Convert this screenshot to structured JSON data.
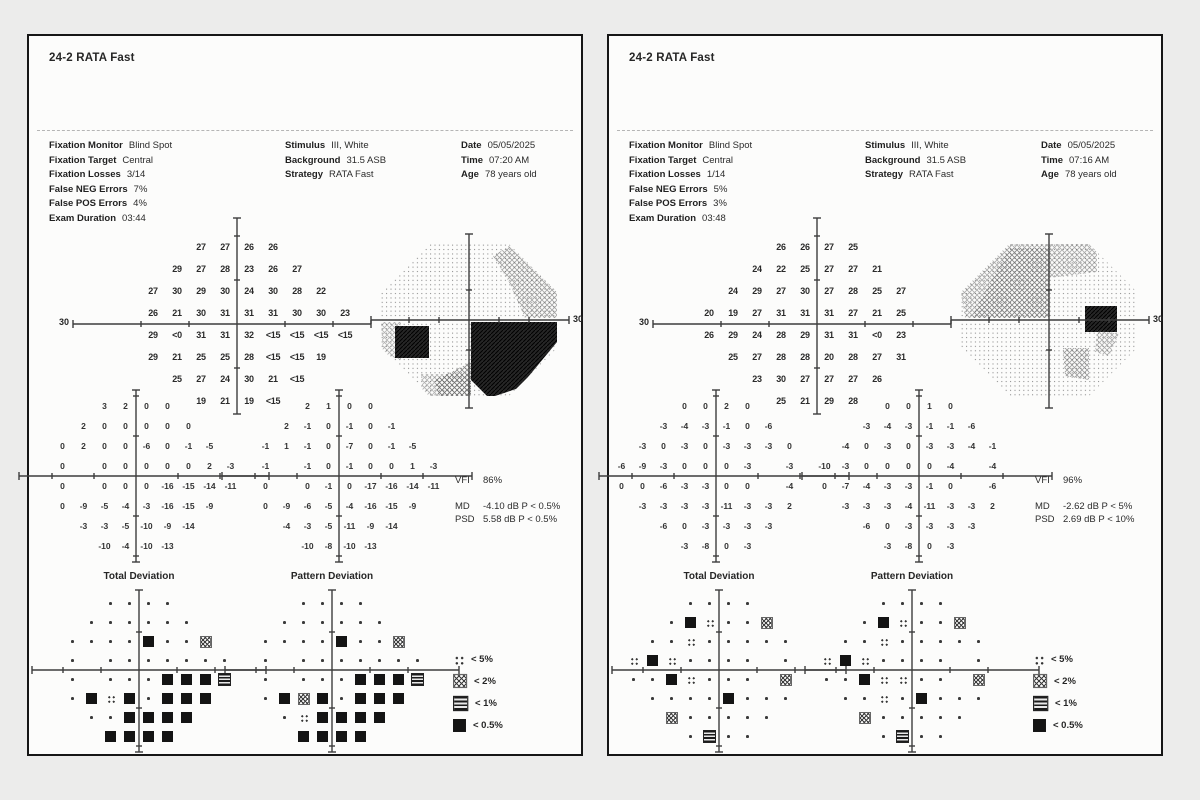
{
  "legend": [
    {
      "sym": "p5",
      "label": "< 5%"
    },
    {
      "sym": "p2",
      "label": "< 2%"
    },
    {
      "sym": "p1",
      "label": "< 1%"
    },
    {
      "sym": "p05",
      "label": "< 0.5%"
    }
  ],
  "pages": [
    {
      "title": "24-2 RATA Fast",
      "info": {
        "col1": [
          [
            "Fixation Monitor",
            "Blind Spot"
          ],
          [
            "Fixation Target",
            "Central"
          ],
          [
            "Fixation Losses",
            "3/14"
          ],
          [
            "False NEG Errors",
            "7%"
          ],
          [
            "False POS Errors",
            "4%"
          ],
          [
            "Exam Duration",
            "03:44"
          ]
        ],
        "col2": [
          [
            "Stimulus",
            "III, White"
          ],
          [
            "Background",
            "31.5 ASB"
          ],
          [
            "Strategy",
            "RATA Fast"
          ]
        ],
        "col3": [
          [
            "Date",
            "05/05/2025"
          ],
          [
            "Time",
            "07:20 AM"
          ],
          [
            "Age",
            "78 years old"
          ]
        ]
      },
      "axis_left_label": "30",
      "axis_right_label": "30",
      "sensitivity": [
        [
          null,
          null,
          null,
          "27",
          "27",
          "26",
          "26",
          null,
          null,
          null
        ],
        [
          null,
          null,
          "29",
          "27",
          "28",
          "23",
          "26",
          "27",
          null,
          null
        ],
        [
          null,
          "27",
          "30",
          "29",
          "30",
          "24",
          "30",
          "28",
          "22",
          null
        ],
        [
          null,
          "26",
          "21",
          "30",
          "31",
          "31",
          "31",
          "30",
          "30",
          "23"
        ],
        [
          null,
          "29",
          "<0",
          "31",
          "31",
          "32",
          "<15",
          "<15",
          "<15",
          "<15"
        ],
        [
          null,
          "29",
          "21",
          "25",
          "25",
          "28",
          "<15",
          "<15",
          "19",
          null
        ],
        [
          null,
          null,
          "25",
          "27",
          "24",
          "30",
          "21",
          "<15",
          null,
          null
        ],
        [
          null,
          null,
          null,
          "19",
          "21",
          "19",
          "<15",
          null,
          null,
          null
        ]
      ],
      "total_deviation": [
        [
          null,
          null,
          null,
          "3",
          "2",
          "0",
          "0",
          null,
          null,
          null
        ],
        [
          null,
          null,
          "2",
          "0",
          "0",
          "0",
          "0",
          "0",
          null,
          null
        ],
        [
          null,
          "0",
          "2",
          "0",
          "0",
          "-6",
          "0",
          "-1",
          "-5",
          null
        ],
        [
          null,
          "0",
          null,
          "0",
          "0",
          "0",
          "0",
          "0",
          "2",
          "-3"
        ],
        [
          null,
          "0",
          null,
          "0",
          "0",
          "0",
          "-16",
          "-15",
          "-14",
          "-11"
        ],
        [
          null,
          "0",
          "-9",
          "-5",
          "-4",
          "-3",
          "-16",
          "-15",
          "-9",
          null
        ],
        [
          null,
          null,
          "-3",
          "-3",
          "-5",
          "-10",
          "-9",
          "-14",
          null,
          null
        ],
        [
          null,
          null,
          null,
          "-10",
          "-4",
          "-10",
          "-13",
          null,
          null,
          null
        ]
      ],
      "pattern_deviation": [
        [
          null,
          null,
          null,
          "2",
          "1",
          "0",
          "0",
          null,
          null,
          null
        ],
        [
          null,
          null,
          "2",
          "-1",
          "0",
          "-1",
          "0",
          "-1",
          null,
          null
        ],
        [
          null,
          "-1",
          "1",
          "-1",
          "0",
          "-7",
          "0",
          "-1",
          "-5",
          null
        ],
        [
          null,
          "-1",
          null,
          "-1",
          "0",
          "-1",
          "0",
          "0",
          "1",
          "-3"
        ],
        [
          null,
          "0",
          null,
          "0",
          "-1",
          "0",
          "-17",
          "-16",
          "-14",
          "-11"
        ],
        [
          null,
          "0",
          "-9",
          "-6",
          "-5",
          "-4",
          "-16",
          "-15",
          "-9",
          null
        ],
        [
          null,
          null,
          "-4",
          "-3",
          "-5",
          "-11",
          "-9",
          "-14",
          null,
          null
        ],
        [
          null,
          null,
          null,
          "-10",
          "-8",
          "-10",
          "-13",
          null,
          null,
          null
        ]
      ],
      "td_plot_title": "Total Deviation",
      "pd_plot_title": "Pattern Deviation",
      "td_plot": [
        [
          null,
          null,
          null,
          "n",
          "n",
          "n",
          "n",
          null,
          null,
          null
        ],
        [
          null,
          null,
          "n",
          "n",
          "n",
          "n",
          "n",
          "n",
          null,
          null
        ],
        [
          null,
          "n",
          "n",
          "n",
          "n",
          "p05",
          "n",
          "n",
          "p2",
          null
        ],
        [
          null,
          "n",
          null,
          "n",
          "n",
          "n",
          "n",
          "n",
          "n",
          "n"
        ],
        [
          null,
          "n",
          null,
          "n",
          "n",
          "n",
          "p05",
          "p05",
          "p05",
          "p1"
        ],
        [
          null,
          "n",
          "p05",
          "p5",
          "p05",
          "n",
          "p05",
          "p05",
          "p05",
          null
        ],
        [
          null,
          null,
          "n",
          "n",
          "p05",
          "p05",
          "p05",
          "p05",
          null,
          null
        ],
        [
          null,
          null,
          null,
          "p05",
          "p05",
          "p05",
          "p05",
          null,
          null,
          null
        ]
      ],
      "pd_plot": [
        [
          null,
          null,
          null,
          "n",
          "n",
          "n",
          "n",
          null,
          null,
          null
        ],
        [
          null,
          null,
          "n",
          "n",
          "n",
          "n",
          "n",
          "n",
          null,
          null
        ],
        [
          null,
          "n",
          "n",
          "n",
          "n",
          "p05",
          "n",
          "n",
          "p2",
          null
        ],
        [
          null,
          "n",
          null,
          "n",
          "n",
          "n",
          "n",
          "n",
          "n",
          "n"
        ],
        [
          null,
          "n",
          null,
          "n",
          "n",
          "n",
          "p05",
          "p05",
          "p05",
          "p1"
        ],
        [
          null,
          "n",
          "p05",
          "p2",
          "p05",
          "n",
          "p05",
          "p05",
          "p05",
          null
        ],
        [
          null,
          null,
          "n",
          "p5",
          "p05",
          "p05",
          "p05",
          "p05",
          null,
          null
        ],
        [
          null,
          null,
          null,
          "p05",
          "p05",
          "p05",
          "p05",
          null,
          null,
          null
        ]
      ],
      "vfi_label": "VFI",
      "vfi": "86%",
      "md_label": "MD",
      "md": "-4.10 dB P < 0.5%",
      "psd_label": "PSD",
      "psd": "5.58 dB P < 0.5%"
    },
    {
      "title": "24-2 RATA Fast",
      "info": {
        "col1": [
          [
            "Fixation Monitor",
            "Blind Spot"
          ],
          [
            "Fixation Target",
            "Central"
          ],
          [
            "Fixation Losses",
            "1/14"
          ],
          [
            "False NEG Errors",
            "5%"
          ],
          [
            "False POS Errors",
            "3%"
          ],
          [
            "Exam Duration",
            "03:48"
          ]
        ],
        "col2": [
          [
            "Stimulus",
            "III, White"
          ],
          [
            "Background",
            "31.5 ASB"
          ],
          [
            "Strategy",
            "RATA Fast"
          ]
        ],
        "col3": [
          [
            "Date",
            "05/05/2025"
          ],
          [
            "Time",
            "07:16 AM"
          ],
          [
            "Age",
            "78 years old"
          ]
        ]
      },
      "axis_left_label": "30",
      "axis_right_label": "30",
      "sensitivity": [
        [
          null,
          null,
          null,
          "26",
          "26",
          "27",
          "25",
          null,
          null,
          null
        ],
        [
          null,
          null,
          "24",
          "22",
          "25",
          "27",
          "27",
          "21",
          null,
          null
        ],
        [
          null,
          "24",
          "29",
          "27",
          "30",
          "27",
          "28",
          "25",
          "27",
          null
        ],
        [
          "20",
          "19",
          "27",
          "31",
          "31",
          "31",
          "27",
          "21",
          "25",
          null
        ],
        [
          "26",
          "29",
          "24",
          "28",
          "29",
          "31",
          "31",
          "<0",
          "23",
          null
        ],
        [
          null,
          "25",
          "27",
          "28",
          "28",
          "20",
          "28",
          "27",
          "31",
          null
        ],
        [
          null,
          null,
          "23",
          "30",
          "27",
          "27",
          "27",
          "26",
          null,
          null
        ],
        [
          null,
          null,
          null,
          "25",
          "21",
          "29",
          "28",
          null,
          null,
          null
        ]
      ],
      "total_deviation": [
        [
          null,
          null,
          null,
          "0",
          "0",
          "2",
          "0",
          null,
          null,
          null
        ],
        [
          null,
          null,
          "-3",
          "-4",
          "-3",
          "-1",
          "0",
          "-6",
          null,
          null
        ],
        [
          null,
          "-3",
          "0",
          "-3",
          "0",
          "-3",
          "-3",
          "-3",
          "0",
          null
        ],
        [
          "-6",
          "-9",
          "-3",
          "0",
          "0",
          "0",
          "-3",
          null,
          "-3",
          null
        ],
        [
          "0",
          "0",
          "-6",
          "-3",
          "-3",
          "0",
          "0",
          null,
          "-4",
          null
        ],
        [
          null,
          "-3",
          "-3",
          "-3",
          "-3",
          "-11",
          "-3",
          "-3",
          "2",
          null
        ],
        [
          null,
          null,
          "-6",
          "0",
          "-3",
          "-3",
          "-3",
          "-3",
          null,
          null
        ],
        [
          null,
          null,
          null,
          "-3",
          "-8",
          "0",
          "-3",
          null,
          null,
          null
        ]
      ],
      "pattern_deviation": [
        [
          null,
          null,
          null,
          "0",
          "0",
          "1",
          "0",
          null,
          null,
          null
        ],
        [
          null,
          null,
          "-3",
          "-4",
          "-3",
          "-1",
          "-1",
          "-6",
          null,
          null
        ],
        [
          null,
          "-4",
          "0",
          "-3",
          "0",
          "-3",
          "-3",
          "-4",
          "-1",
          null
        ],
        [
          "-10",
          "-3",
          "0",
          "0",
          "0",
          "0",
          "-4",
          null,
          "-4",
          null
        ],
        [
          "0",
          "-7",
          "-4",
          "-3",
          "-3",
          "-1",
          "0",
          null,
          "-6",
          null
        ],
        [
          null,
          "-3",
          "-3",
          "-3",
          "-4",
          "-11",
          "-3",
          "-3",
          "2",
          null
        ],
        [
          null,
          null,
          "-6",
          "0",
          "-3",
          "-3",
          "-3",
          "-3",
          null,
          null
        ],
        [
          null,
          null,
          null,
          "-3",
          "-8",
          "0",
          "-3",
          null,
          null,
          null
        ]
      ],
      "td_plot_title": "Total Deviation",
      "pd_plot_title": "Pattern Deviation",
      "td_plot": [
        [
          null,
          null,
          null,
          "n",
          "n",
          "n",
          "n",
          null,
          null,
          null
        ],
        [
          null,
          null,
          "n",
          "p05",
          "p5",
          "n",
          "n",
          "p2",
          null,
          null
        ],
        [
          null,
          "n",
          "n",
          "p5",
          "n",
          "n",
          "n",
          "n",
          "n",
          null
        ],
        [
          "p5",
          "p05",
          "p5",
          "n",
          "n",
          "n",
          "n",
          null,
          "n",
          null
        ],
        [
          "n",
          "n",
          "p05",
          "p5",
          "n",
          "n",
          "n",
          null,
          "p2",
          null
        ],
        [
          null,
          "n",
          "n",
          "n",
          "n",
          "p05",
          "n",
          "n",
          "n",
          null
        ],
        [
          null,
          null,
          "p2",
          "n",
          "n",
          "n",
          "n",
          "n",
          null,
          null
        ],
        [
          null,
          null,
          null,
          "n",
          "p1",
          "n",
          "n",
          null,
          null,
          null
        ]
      ],
      "pd_plot": [
        [
          null,
          null,
          null,
          "n",
          "n",
          "n",
          "n",
          null,
          null,
          null
        ],
        [
          null,
          null,
          "n",
          "p05",
          "p5",
          "n",
          "n",
          "p2",
          null,
          null
        ],
        [
          null,
          "n",
          "n",
          "p5",
          "n",
          "n",
          "n",
          "n",
          "n",
          null
        ],
        [
          "p5",
          "p05",
          "p5",
          "n",
          "n",
          "n",
          "n",
          null,
          "n",
          null
        ],
        [
          "n",
          "n",
          "p05",
          "p5",
          "p5",
          "n",
          "n",
          null,
          "p2",
          null
        ],
        [
          null,
          "n",
          "n",
          "p5",
          "n",
          "p05",
          "n",
          "n",
          "n",
          null
        ],
        [
          null,
          null,
          "p2",
          "n",
          "n",
          "n",
          "n",
          "n",
          null,
          null
        ],
        [
          null,
          null,
          null,
          "n",
          "p1",
          "n",
          "n",
          null,
          null,
          null
        ]
      ],
      "vfi_label": "VFI",
      "vfi": "96%",
      "md_label": "MD",
      "md": "-2.62 dB P < 5%",
      "psd_label": "PSD",
      "psd": "2.69 dB P < 10%"
    }
  ]
}
